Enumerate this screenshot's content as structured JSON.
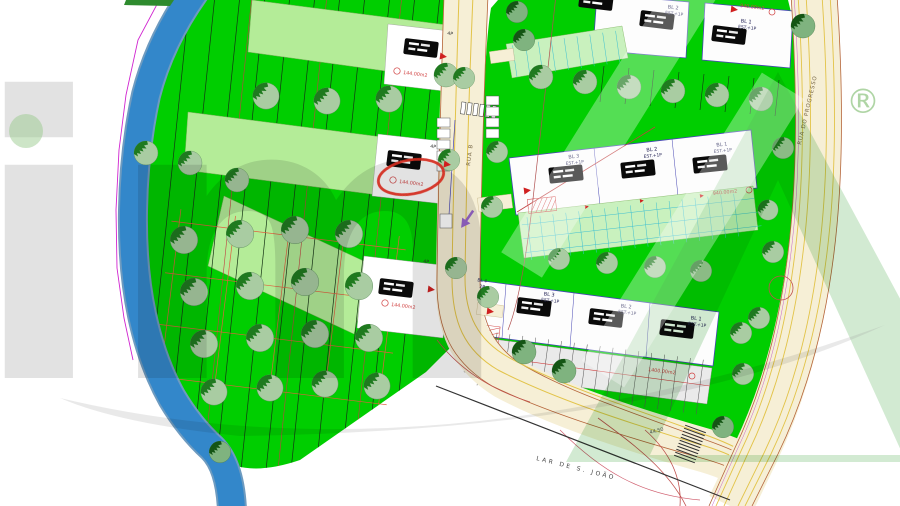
{
  "streets": {
    "rua_b": "RUA B",
    "rua_progresso": "RUA DO PROGRESSO"
  },
  "labels": {
    "landmark": "LAR  DE  S.  JOÃO",
    "dimension": "44.50"
  },
  "left_strips": [
    {
      "floors": "4P",
      "area": "144.00m2"
    },
    {
      "floors": "4P",
      "area": "144.00m2",
      "highlighted": true
    },
    {
      "floors": "4P",
      "area": "144.00m2"
    }
  ],
  "blocks": {
    "top": {
      "area": "940.00m2",
      "lots": [
        {
          "name": "BL 2",
          "type": "EST.+1P"
        },
        {
          "name": "BL 1",
          "type": "EST.+1P"
        }
      ]
    },
    "middle": {
      "area": "940.00m2",
      "lots": [
        {
          "name": "BL 3",
          "type": "EST.+1P"
        },
        {
          "name": "BL 2",
          "type": "EST.+1P"
        },
        {
          "name": "BL 1",
          "type": "EST.+1P"
        }
      ]
    },
    "bottom": {
      "area": "1400.00m2",
      "side_name": "BL 4",
      "side_floors": "2P",
      "lots": [
        {
          "name": "BL 3",
          "type": "EST.+1P"
        },
        {
          "name": "BL 2",
          "type": "EST.+1P"
        },
        {
          "name": "BL 1",
          "type": "EST.+1P"
        }
      ]
    }
  },
  "annotation": {
    "shape": "ellipse",
    "color": "#D42B1E",
    "target_area": "144.00m2"
  },
  "watermark": {
    "text_left": "im",
    "letter_right": "A",
    "registered": "®"
  },
  "colors": {
    "field_green": "#00CE00",
    "building_green": "#B4EC98",
    "river_blue": "#3387CA",
    "road_beige": "#F6EFD6",
    "lot_outline": "#4646B4",
    "annotation_red": "#D42B1E",
    "area_red": "#D04040",
    "watermark_green": "#9CCB8F",
    "boundary_magenta": "#D024D0"
  }
}
